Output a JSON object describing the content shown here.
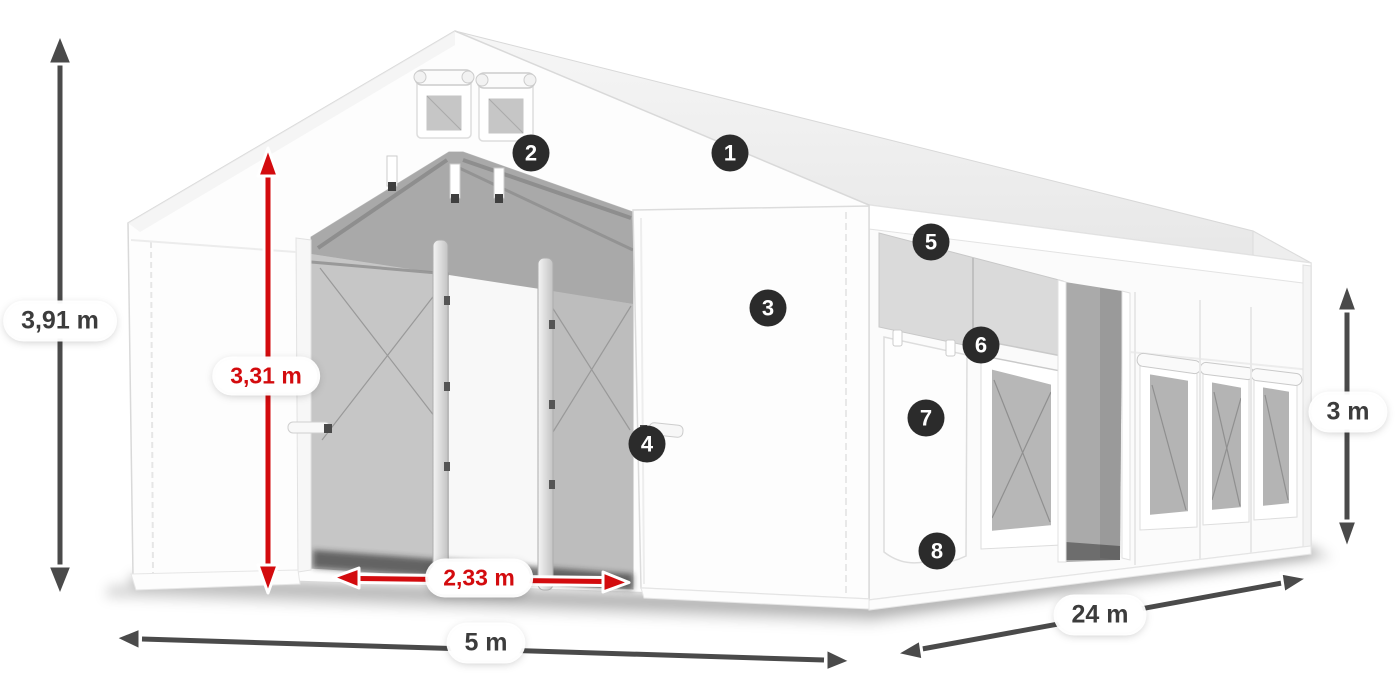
{
  "figure": {
    "type": "product-dimension-diagram",
    "subject": "White tarpaulin storage tent, open front entrance with mesh interior, gable vents, side wall with mesh windows and side door"
  },
  "dimensions": {
    "total_height": {
      "label": "3,91 m",
      "style": "dark",
      "measures": "total outer height"
    },
    "inner_height": {
      "label": "3,31 m",
      "style": "red",
      "measures": "entrance clear height"
    },
    "door_width": {
      "label": "2,33 m",
      "style": "red",
      "measures": "entrance clear width"
    },
    "front_width": {
      "label": "5 m",
      "style": "dark",
      "measures": "tent width"
    },
    "side_length": {
      "label": "24 m",
      "style": "dark",
      "measures": "tent length"
    },
    "side_height": {
      "label": "3 m",
      "style": "dark",
      "measures": "side wall height"
    }
  },
  "callouts": [
    {
      "number": "1"
    },
    {
      "number": "2"
    },
    {
      "number": "3"
    },
    {
      "number": "4"
    },
    {
      "number": "5"
    },
    {
      "number": "6"
    },
    {
      "number": "7"
    },
    {
      "number": "8"
    }
  ],
  "colors": {
    "background": "#ffffff",
    "dimension_dark": "#4a4a4a",
    "dimension_red": "#d30b0e",
    "label_text_dark": "#3c3c3c",
    "badge_background": "#2b2b2b",
    "badge_text": "#ffffff",
    "tent_white": "#fdfdfd",
    "mesh_gray": "#bdbdbd",
    "interior_gray": "#a9a9a9"
  }
}
